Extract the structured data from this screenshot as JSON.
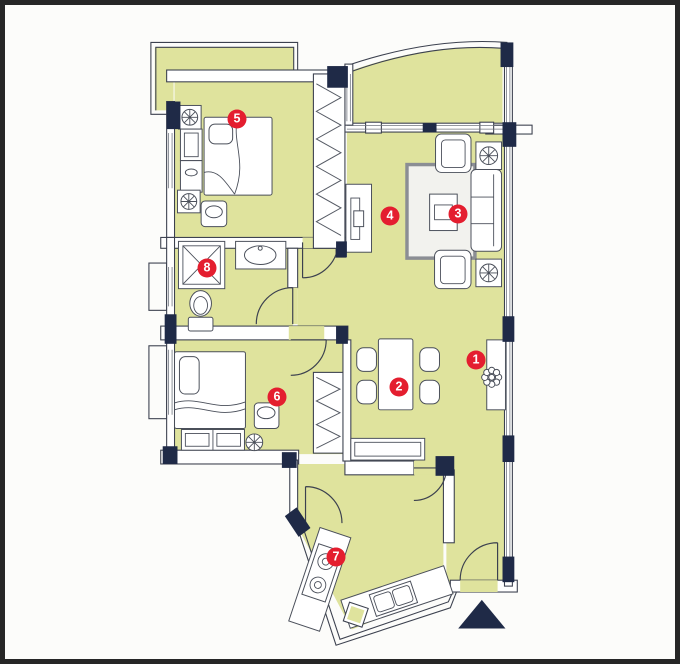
{
  "title": "apartment-floor-plan",
  "rooms": [
    {
      "number": "1"
    },
    {
      "number": "2"
    },
    {
      "number": "3"
    },
    {
      "number": "4"
    },
    {
      "number": "5"
    },
    {
      "number": "6"
    },
    {
      "number": "7"
    },
    {
      "number": "8"
    }
  ],
  "north_arrow_symbol": "▲",
  "colors": {
    "floor": "#dfe39d",
    "wall_dark": "#1f2a47",
    "wall_line": "#3c414f",
    "furn_line": "#4a4f5a",
    "marker_red": "#e41e2f",
    "rug_border": "#8b8e94",
    "frame": "#262626",
    "paper": "#fcfcfa"
  }
}
